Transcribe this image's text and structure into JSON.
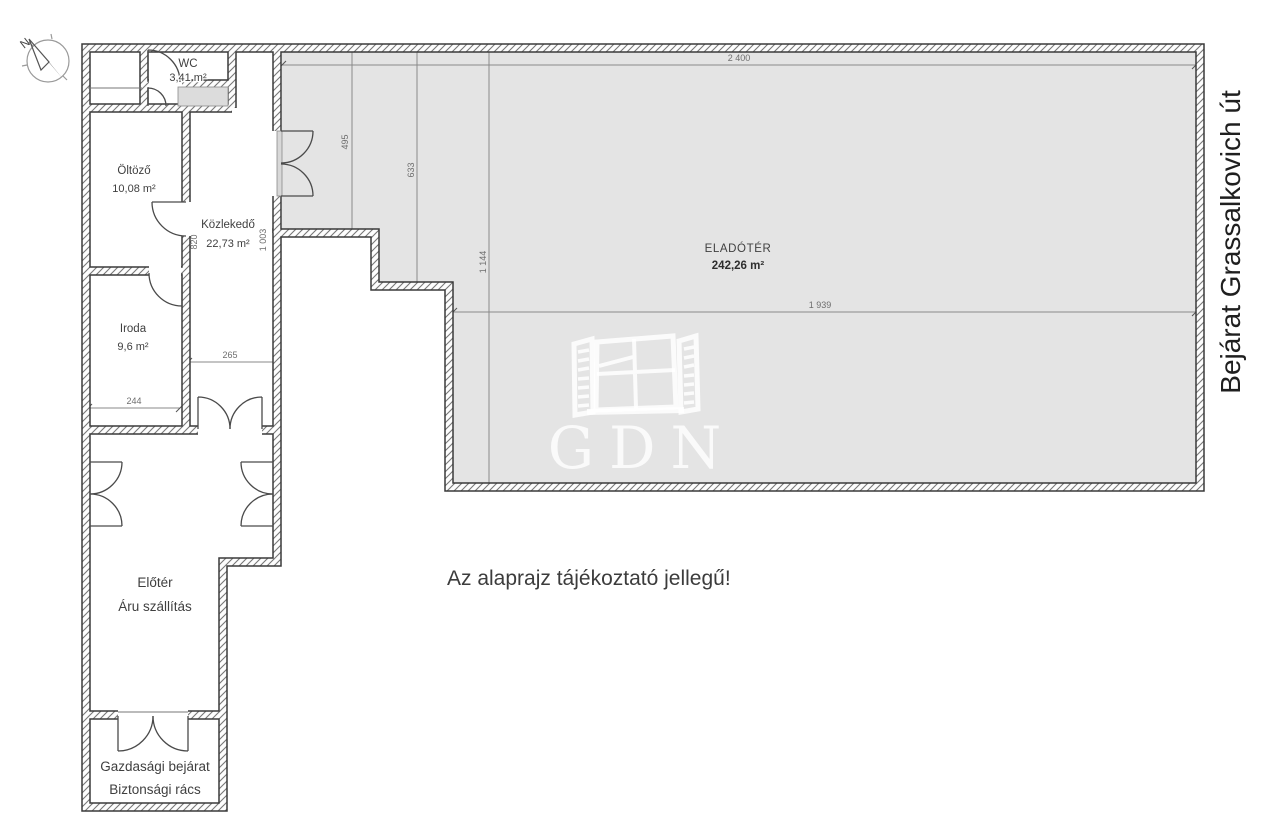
{
  "floorplan": {
    "note": "Az alaprajz tájékoztató jellegű!",
    "street_label": "Bejárat Grassalkovich út",
    "compass_north_label": "N",
    "watermark": "GDN",
    "rooms": {
      "wc": {
        "name": "WC",
        "area": "3,41 m²"
      },
      "oltozo": {
        "name": "Öltöző",
        "area": "10,08 m²"
      },
      "kozlekedo": {
        "name": "Közlekedő",
        "area": "22,73 m²"
      },
      "iroda": {
        "name": "Iroda",
        "area": "9,6 m²"
      },
      "eladoter": {
        "name": "ELADÓTÉR",
        "area": "242,26 m²"
      },
      "eloter": {
        "line1": "Előtér",
        "line2": "Áru szállítás"
      },
      "gazdasagi_bejarat": {
        "line1": "Gazdasági bejárat",
        "line2": "Biztonsági rács"
      }
    },
    "dimensions": {
      "sales_top_width": "2 400",
      "sales_inner_width": "1 939",
      "sales_depth_left": "495",
      "sales_depth_mid": "633",
      "sales_depth_right": "1 144",
      "corridor_length": "820",
      "corridor_length_right": "1 003",
      "corridor_width": "265",
      "iroda_width": "244"
    },
    "colors": {
      "sales_area_fill": "#e4e4e4",
      "wall_line": "#3a3a3a",
      "dim_text": "#6e6e6e",
      "label_text": "#3f3f3f"
    }
  }
}
